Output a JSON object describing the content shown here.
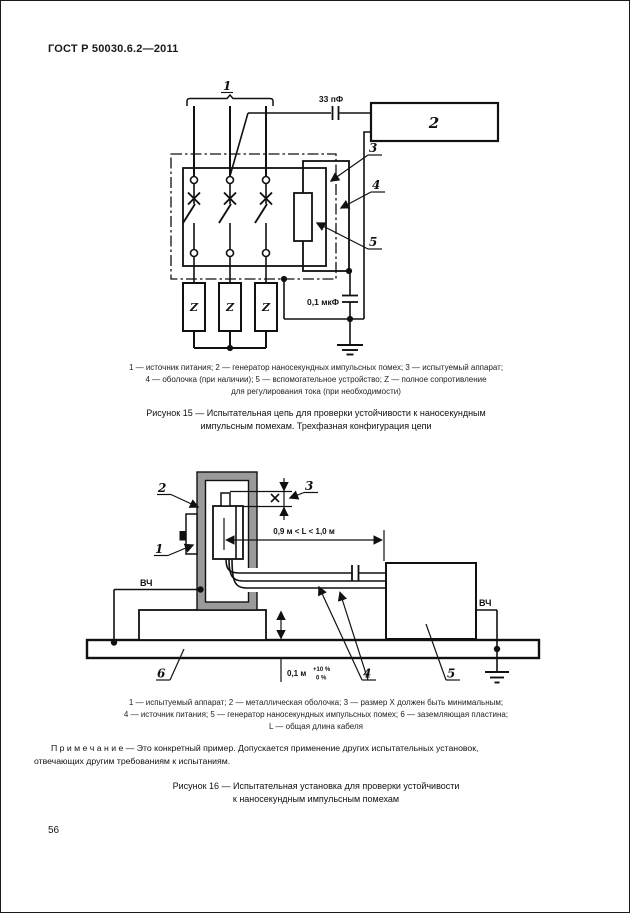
{
  "page": {
    "header": "ГОСТ Р 50030.6.2—2011",
    "number": "56"
  },
  "colors": {
    "enclosure_gray": "#9a9a9a",
    "line": "#111111"
  },
  "fig15": {
    "labels": {
      "l1": "1",
      "l2": "2",
      "l3": "3",
      "l4": "4",
      "l5": "5"
    },
    "impedance": "Z",
    "cap_coupling": "33 пФ",
    "cap_ground": "0,1 мкФ",
    "legend": [
      "1 — источник питания; 2 — генератор наносекундных импульсных помех; 3 — испытуемый аппарат;",
      "4 — оболочка (при наличии); 5 — вспомогательное устройство; Z — полное сопротивление",
      "для регулирования тока (при необходимости)"
    ],
    "title": [
      "Рисунок 15 — Испытательная цепь для проверки устойчивости к наносекундным",
      "импульсным помехам. Трехфазная конфигурация цепи"
    ]
  },
  "fig16": {
    "labels": {
      "l1": "1",
      "l2": "2",
      "l3": "3",
      "l4": "4",
      "l5": "5",
      "l6": "6"
    },
    "hf_left": "ВЧ",
    "hf_right": "ВЧ",
    "dim_cable": "0,9 м < L < 1,0 м",
    "dim_height": "0,1 м",
    "tol_plus": "+10 %",
    "tol_zero": "0 %",
    "legend": [
      "1 — испытуемый аппарат; 2 — металлическая оболочка; 3 — размер X должен быть минимальным;",
      "4 — источник питания; 5 — генератор наносекундных импульсных помех; 6 — заземляющая пластина;",
      "L — общая длина кабеля"
    ],
    "note": [
      "П р и м е ч а н и е — Это конкретный пример.  Допускается применение других испытательных установок,",
      "отвечающих другим требованиям к испытаниям."
    ],
    "title": [
      "Рисунок 16 — Испытательная установка для проверки устойчивости",
      "к наносекундным импульсным помехам"
    ]
  }
}
